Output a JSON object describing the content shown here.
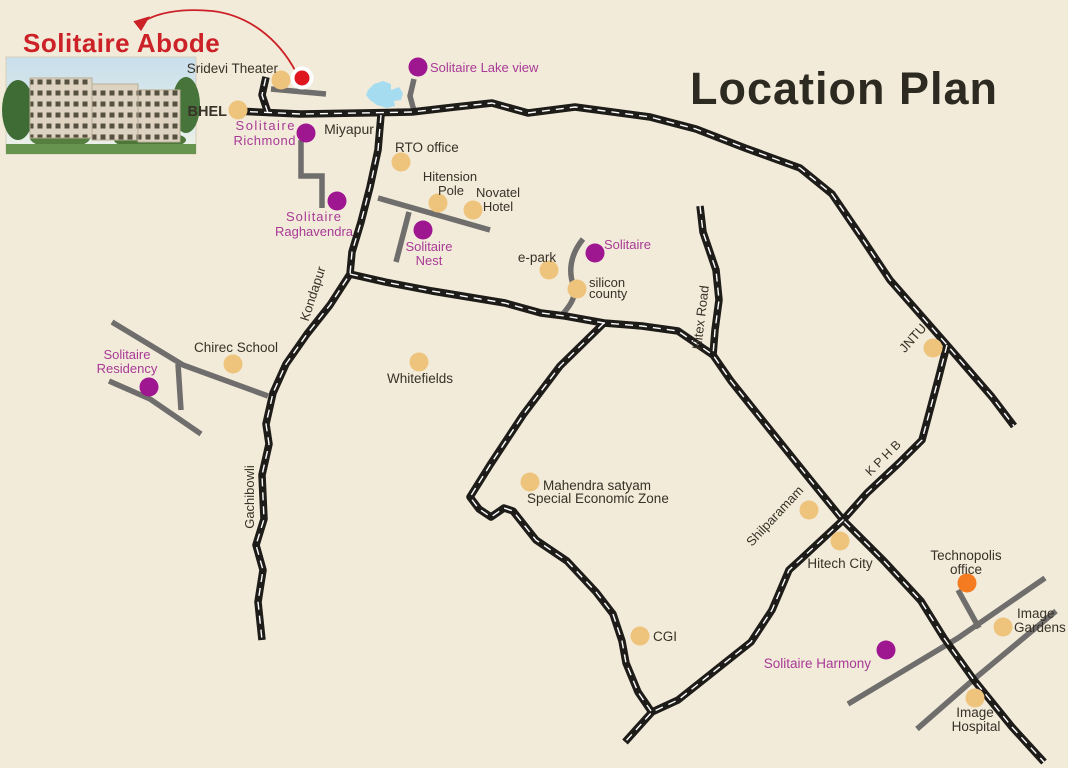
{
  "title": "Location Plan",
  "project": {
    "name": "Solitaire Abode"
  },
  "colors": {
    "background": "#f2ebda",
    "road_major": "#1e1c19",
    "road_minor": "#6f6e6c",
    "dot_tan": "#eec47d",
    "dot_purple": "#9e1690",
    "dot_orange": "#f47b20",
    "dot_red": "#e0161f",
    "label_dark": "#383127",
    "label_pink": "#a93a96",
    "label_red": "#cb2127",
    "title_color": "#2d2a21",
    "lake": "#a6dcf0"
  },
  "markers": [
    {
      "id": "sridevi-theater",
      "dot": {
        "type": "tan",
        "x": 281,
        "y": 80
      },
      "labels": [
        {
          "text": "Sridevi Theater",
          "x": 278,
          "y": 73,
          "anchor": "end",
          "color": "dark",
          "size": 13.5
        }
      ]
    },
    {
      "id": "solitaire-abode-location",
      "dot": {
        "type": "red-ring",
        "x": 302,
        "y": 78
      },
      "labels": []
    },
    {
      "id": "bhel",
      "dot": {
        "type": "tan",
        "x": 238,
        "y": 110
      },
      "labels": [
        {
          "text": "BHEL",
          "x": 227,
          "y": 116,
          "anchor": "end",
          "color": "dark",
          "size": 14.5,
          "weight": 700
        }
      ]
    },
    {
      "id": "solitaire-richmond",
      "dot": {
        "type": "purple",
        "x": 306,
        "y": 133
      },
      "labels": [
        {
          "text": "Solitaire",
          "x": 296,
          "y": 130,
          "anchor": "end",
          "color": "pink",
          "size": 13,
          "spacing": 1.5
        },
        {
          "text": "Richmond",
          "x": 296,
          "y": 145,
          "anchor": "end",
          "color": "pink",
          "size": 13,
          "spacing": 0.5
        }
      ]
    },
    {
      "id": "miyapur",
      "labels": [
        {
          "text": "Miyapur",
          "x": 349,
          "y": 134,
          "anchor": "middle",
          "color": "dark",
          "size": 14
        }
      ]
    },
    {
      "id": "solitaire-lake-view",
      "dot": {
        "type": "purple",
        "x": 418,
        "y": 67
      },
      "labels": [
        {
          "text": "Solitaire Lake view",
          "x": 430,
          "y": 72,
          "anchor": "start",
          "color": "pink",
          "size": 13
        }
      ]
    },
    {
      "id": "rto-office",
      "dot": {
        "type": "tan",
        "x": 401,
        "y": 162
      },
      "labels": [
        {
          "text": "RTO office",
          "x": 395,
          "y": 152,
          "anchor": "start",
          "color": "dark",
          "size": 13.5
        }
      ]
    },
    {
      "id": "hitension-pole",
      "dot": {
        "type": "tan",
        "x": 438,
        "y": 203
      },
      "labels": [
        {
          "text": "Hitension",
          "x": 450,
          "y": 181,
          "anchor": "middle",
          "color": "dark",
          "size": 13
        },
        {
          "text": "Pole",
          "x": 451,
          "y": 195,
          "anchor": "middle",
          "color": "dark",
          "size": 13
        }
      ]
    },
    {
      "id": "novatel-hotel",
      "dot": {
        "type": "tan",
        "x": 473,
        "y": 210
      },
      "labels": [
        {
          "text": "Novatel",
          "x": 498,
          "y": 197,
          "anchor": "middle",
          "color": "dark",
          "size": 13
        },
        {
          "text": "Hotel",
          "x": 498,
          "y": 211,
          "anchor": "middle",
          "color": "dark",
          "size": 13
        }
      ]
    },
    {
      "id": "solitaire-raghavendra",
      "dot": {
        "type": "purple",
        "x": 337,
        "y": 201
      },
      "labels": [
        {
          "text": "Solitaire",
          "x": 314,
          "y": 221,
          "anchor": "middle",
          "color": "pink",
          "size": 13,
          "spacing": 1
        },
        {
          "text": "Raghavendra",
          "x": 314,
          "y": 236,
          "anchor": "middle",
          "color": "pink",
          "size": 13
        }
      ]
    },
    {
      "id": "solitaire-nest",
      "dot": {
        "type": "purple",
        "x": 423,
        "y": 230
      },
      "labels": [
        {
          "text": "Solitaire",
          "x": 429,
          "y": 251,
          "anchor": "middle",
          "color": "pink",
          "size": 13
        },
        {
          "text": "Nest",
          "x": 429,
          "y": 265,
          "anchor": "middle",
          "color": "pink",
          "size": 13
        }
      ]
    },
    {
      "id": "e-park",
      "dot": {
        "type": "tan",
        "x": 549,
        "y": 270
      },
      "labels": [
        {
          "text": "e-park",
          "x": 537,
          "y": 262,
          "anchor": "middle",
          "color": "dark",
          "size": 13.5
        }
      ]
    },
    {
      "id": "solitaire-epark",
      "dot": {
        "type": "purple",
        "x": 595,
        "y": 253
      },
      "labels": [
        {
          "text": "Solitaire",
          "x": 604,
          "y": 249,
          "anchor": "start",
          "color": "pink",
          "size": 13
        }
      ]
    },
    {
      "id": "silicon-county",
      "dot": {
        "type": "tan",
        "x": 577,
        "y": 289
      },
      "labels": [
        {
          "text": "silicon",
          "x": 589,
          "y": 287,
          "anchor": "start",
          "color": "dark",
          "size": 13
        },
        {
          "text": "county",
          "x": 589,
          "y": 298,
          "anchor": "start",
          "color": "dark",
          "size": 13
        }
      ]
    },
    {
      "id": "chirec-school",
      "dot": {
        "type": "tan",
        "x": 233,
        "y": 364
      },
      "labels": [
        {
          "text": "Chirec School",
          "x": 236,
          "y": 352,
          "anchor": "middle",
          "color": "dark",
          "size": 13.5
        }
      ]
    },
    {
      "id": "solitaire-residency",
      "dot": {
        "type": "purple",
        "x": 149,
        "y": 387
      },
      "labels": [
        {
          "text": "Solitaire",
          "x": 127,
          "y": 359,
          "anchor": "middle",
          "color": "pink",
          "size": 13
        },
        {
          "text": "Residency",
          "x": 127,
          "y": 373,
          "anchor": "middle",
          "color": "pink",
          "size": 13
        }
      ]
    },
    {
      "id": "whitefields",
      "dot": {
        "type": "tan",
        "x": 419,
        "y": 362
      },
      "labels": [
        {
          "text": "Whitefields",
          "x": 420,
          "y": 383,
          "anchor": "middle",
          "color": "dark",
          "size": 13.5
        }
      ]
    },
    {
      "id": "mahendra-satyam-sez",
      "dot": {
        "type": "tan",
        "x": 530,
        "y": 482
      },
      "labels": [
        {
          "text": "Mahendra satyam",
          "x": 543,
          "y": 490,
          "anchor": "start",
          "color": "dark",
          "size": 13.5
        },
        {
          "text": "Special Economic Zone",
          "x": 527,
          "y": 503,
          "anchor": "start",
          "color": "dark",
          "size": 13.5
        }
      ]
    },
    {
      "id": "shilparamam",
      "dot": {
        "type": "tan",
        "x": 809,
        "y": 510
      },
      "labels": [
        {
          "text": "Shilparamam",
          "x": 778,
          "y": 519,
          "anchor": "middle",
          "color": "dark",
          "size": 13,
          "rotate": -47
        }
      ]
    },
    {
      "id": "hitech-city",
      "dot": {
        "type": "tan",
        "x": 840,
        "y": 541
      },
      "labels": [
        {
          "text": "Hitech City",
          "x": 840,
          "y": 568,
          "anchor": "middle",
          "color": "dark",
          "size": 13.5
        }
      ]
    },
    {
      "id": "jntu",
      "dot": {
        "type": "tan",
        "x": 933,
        "y": 348
      },
      "labels": [
        {
          "text": "JNTU",
          "x": 916,
          "y": 341,
          "anchor": "middle",
          "color": "dark",
          "size": 13,
          "rotate": -48
        }
      ]
    },
    {
      "id": "technopolis-office",
      "dot": {
        "type": "orange",
        "x": 967,
        "y": 583
      },
      "labels": [
        {
          "text": "Technopolis",
          "x": 966,
          "y": 560,
          "anchor": "middle",
          "color": "dark",
          "size": 13.5
        },
        {
          "text": "office",
          "x": 966,
          "y": 574,
          "anchor": "middle",
          "color": "dark",
          "size": 13.5
        }
      ]
    },
    {
      "id": "image-gardens",
      "dot": {
        "type": "tan",
        "x": 1003,
        "y": 627
      },
      "labels": [
        {
          "text": "Image",
          "x": 1017,
          "y": 618,
          "anchor": "start",
          "color": "dark",
          "size": 13.5
        },
        {
          "text": "Gardens",
          "x": 1014,
          "y": 632,
          "anchor": "start",
          "color": "dark",
          "size": 13.5
        }
      ]
    },
    {
      "id": "cgi",
      "dot": {
        "type": "tan",
        "x": 640,
        "y": 636
      },
      "labels": [
        {
          "text": "CGI",
          "x": 653,
          "y": 641,
          "anchor": "start",
          "color": "dark",
          "size": 13.5
        }
      ]
    },
    {
      "id": "solitaire-harmony",
      "dot": {
        "type": "purple",
        "x": 886,
        "y": 650
      },
      "labels": [
        {
          "text": "Solitaire Harmony",
          "x": 871,
          "y": 668,
          "anchor": "end",
          "color": "pink",
          "size": 13.5
        }
      ]
    },
    {
      "id": "image-hospital",
      "dot": {
        "type": "tan",
        "x": 975,
        "y": 698
      },
      "labels": [
        {
          "text": "Image",
          "x": 975,
          "y": 717,
          "anchor": "middle",
          "color": "dark",
          "size": 13.5
        },
        {
          "text": "Hospital",
          "x": 976,
          "y": 731,
          "anchor": "middle",
          "color": "dark",
          "size": 13.5
        }
      ]
    }
  ],
  "road_labels": [
    {
      "id": "kondapur",
      "text": "Kondapur",
      "x": 317,
      "y": 295,
      "rotate": -72,
      "size": 13
    },
    {
      "id": "gachibowli",
      "text": "Gachibowli",
      "x": 254,
      "y": 497,
      "rotate": -90,
      "size": 13
    },
    {
      "id": "hitex-road",
      "text": "Hitex Road",
      "x": 705,
      "y": 318,
      "rotate": -83,
      "size": 13
    },
    {
      "id": "kphb",
      "text": "K P H B",
      "x": 886,
      "y": 461,
      "rotate": -45,
      "size": 12.5
    }
  ]
}
